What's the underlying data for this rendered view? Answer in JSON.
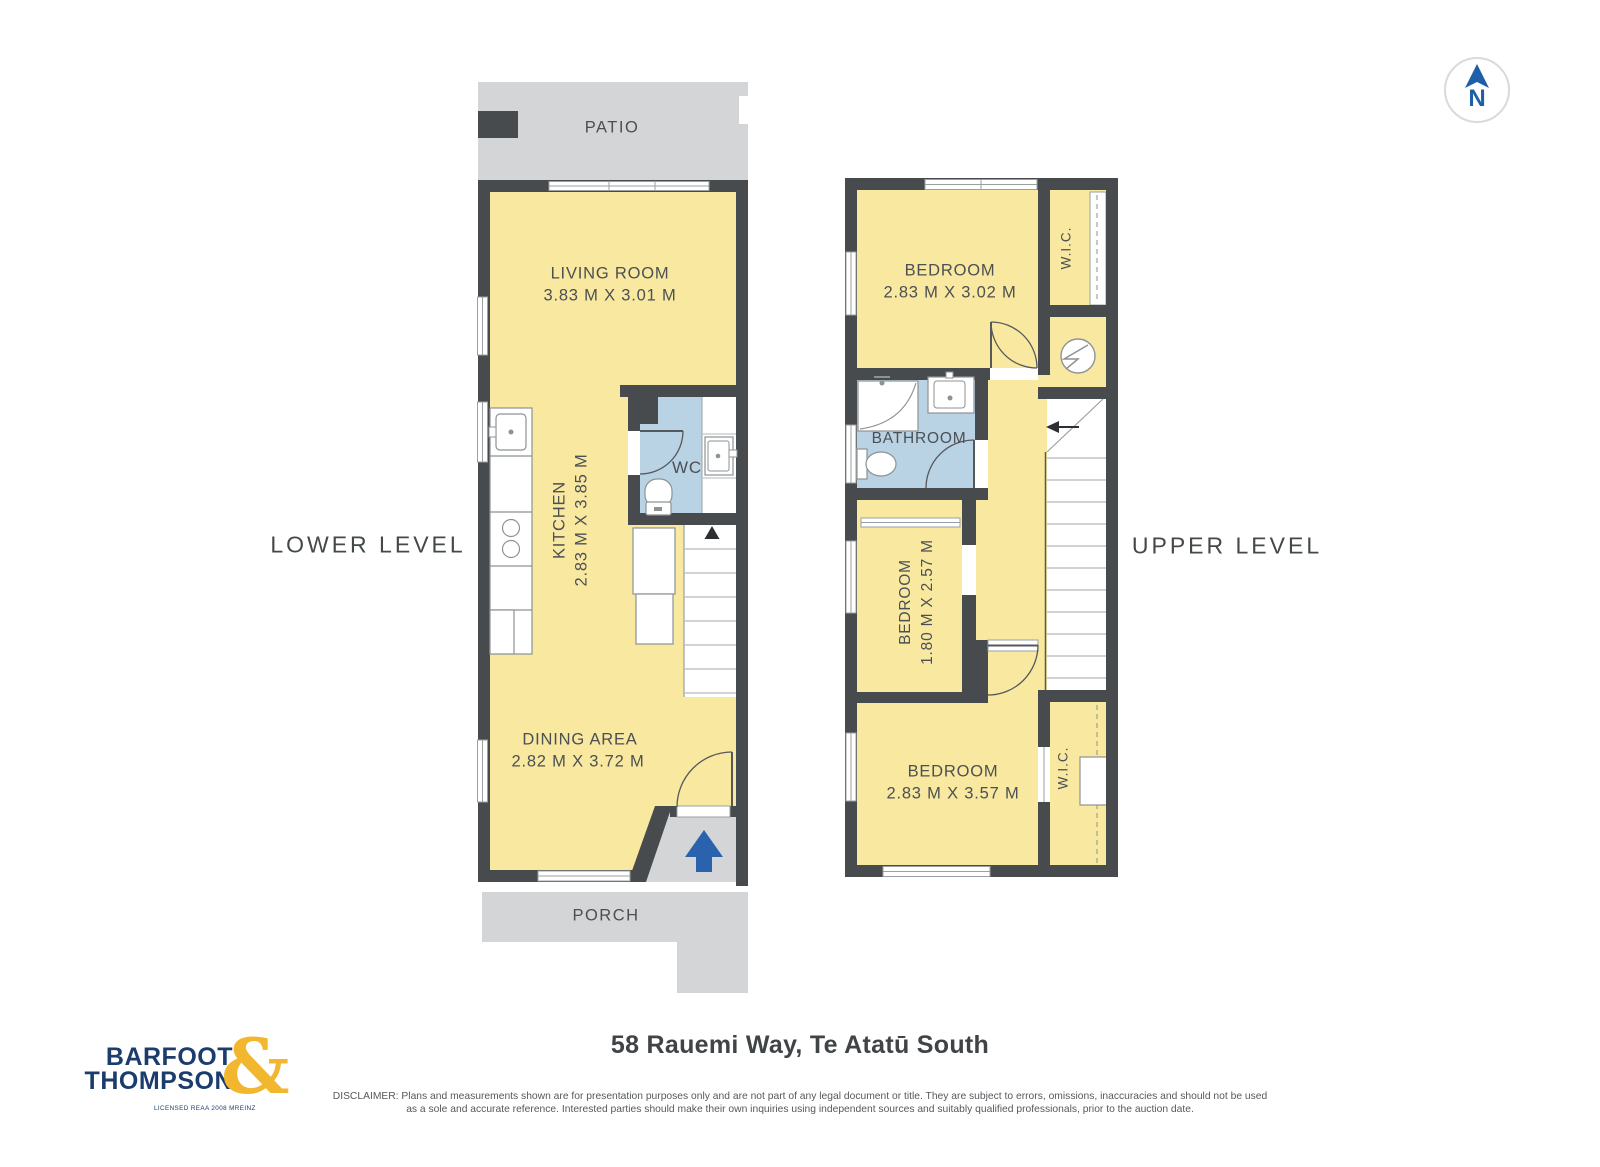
{
  "compass": {
    "north_label": "N"
  },
  "levels": {
    "lower": {
      "label": "LOWER LEVEL",
      "patio": {
        "name": "PATIO"
      },
      "porch": {
        "name": "PORCH"
      },
      "living": {
        "name": "LIVING ROOM",
        "dims": "3.83 M X 3.01 M"
      },
      "kitchen": {
        "name": "KITCHEN",
        "dims": "2.83 M X 3.85 M"
      },
      "wc": {
        "name": "WC"
      },
      "dining": {
        "name": "DINING AREA",
        "dims": "2.82 M X 3.72 M"
      }
    },
    "upper": {
      "label": "UPPER LEVEL",
      "bedroom1": {
        "name": "BEDROOM",
        "dims": "2.83 M X 3.02 M"
      },
      "wic1": {
        "name": "W.I.C."
      },
      "bathroom": {
        "name": "BATHROOM"
      },
      "bedroom2": {
        "name": "BEDROOM",
        "dims": "1.80 M X 2.57 M"
      },
      "bedroom3": {
        "name": "BEDROOM",
        "dims": "2.83 M X 3.57 M"
      },
      "wic2": {
        "name": "W.I.C."
      }
    }
  },
  "footer": {
    "logo": {
      "line1": "BARFOOT",
      "line2": "THOMPSON",
      "ampersand": "&",
      "tagline": "LICENSED REAA 2008 MREINZ"
    },
    "address": "58 Rauemi Way, Te Atatū South",
    "disclaimer_line1": "DISCLAIMER: Plans and measurements shown are for presentation purposes only and are not part of any legal document or title. They are subject to errors, omissions, inaccuracies and should not be used",
    "disclaimer_line2": "as a sole and accurate reference. Interested parties should make their own inquiries using independent sources and suitably qualified professionals, prior to the auction date."
  },
  "colors": {
    "room_fill": "#F9E8A0",
    "wet_room_fill": "#B9D2E4",
    "outdoor_fill": "#D3D5D6",
    "wall": "#474B4E",
    "accent_blue": "#2A62AE",
    "logo_navy": "#1D3C6E",
    "logo_gold": "#F2B72F"
  }
}
